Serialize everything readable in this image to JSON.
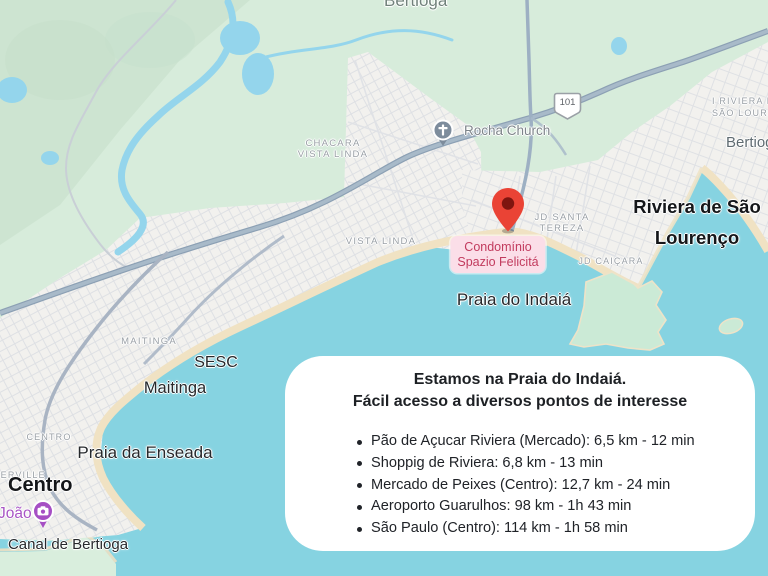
{
  "map": {
    "labels": {
      "bertioga_top": "Bertioga",
      "chacara_line1": "CHACARA",
      "chacara_line2": "VISTA LINDA",
      "vista_linda": "VISTA LINDA",
      "maitinga_caps": "MAITINGA",
      "centro_caps": "CENTRO",
      "terville": "TERVILLE",
      "rocha_church": "Rocha Church",
      "route_101": "101",
      "i_riviera_line1": "I RIVIERA DE",
      "i_riviera_line2": "SÃO LOURENÇO",
      "bertioga_right": "Bertioga",
      "riviera_line1": "Riviera de São",
      "riviera_line2": "Lourenço",
      "jd_santa_tereza_line1": "JD SANTA",
      "jd_santa_tereza_line2": "TEREZA",
      "jd_caicara": "JD CAIÇARA",
      "condominio_line1": "Condomínio",
      "condominio_line2": "Spazio Felicitá",
      "praia_do_indaia": "Praia do Indaiá",
      "sesc": "SESC",
      "maitinga": "Maitinga",
      "praia_da_enseada": "Praia da Enseada",
      "centro": "Centro",
      "joao": "João",
      "canal_de_bertioga": "Canal de Bertioga"
    },
    "icons": {
      "pin": "red-map-pin",
      "church": "church-icon",
      "camera": "attraction-camera-icon",
      "shield": "route-101-shield"
    },
    "colors": {
      "water": "#86d3e1",
      "land_green": "#d7ecdb",
      "urban": "#f2f1ee",
      "sand": "#f0e2c3",
      "highway": "#9db0c3",
      "pin_red": "#EA4335",
      "condo_label_bg": "#fbdee8",
      "condo_label_text": "#c23b5e"
    }
  },
  "card": {
    "title_line1": "Estamos na Praia do Indaiá.",
    "title_line2": "Fácil acesso a diversos pontos de interesse",
    "items": [
      "Pão de Açucar Riviera (Mercado): 6,5 km - 12 min",
      "Shoppig de Riviera: 6,8 km - 13 min",
      "Mercado de Peixes (Centro): 12,7 km - 24 min",
      "Aeroporto Guarulhos: 98 km - 1h 43 min",
      "São Paulo (Centro): 114 km - 1h 58 min"
    ]
  }
}
